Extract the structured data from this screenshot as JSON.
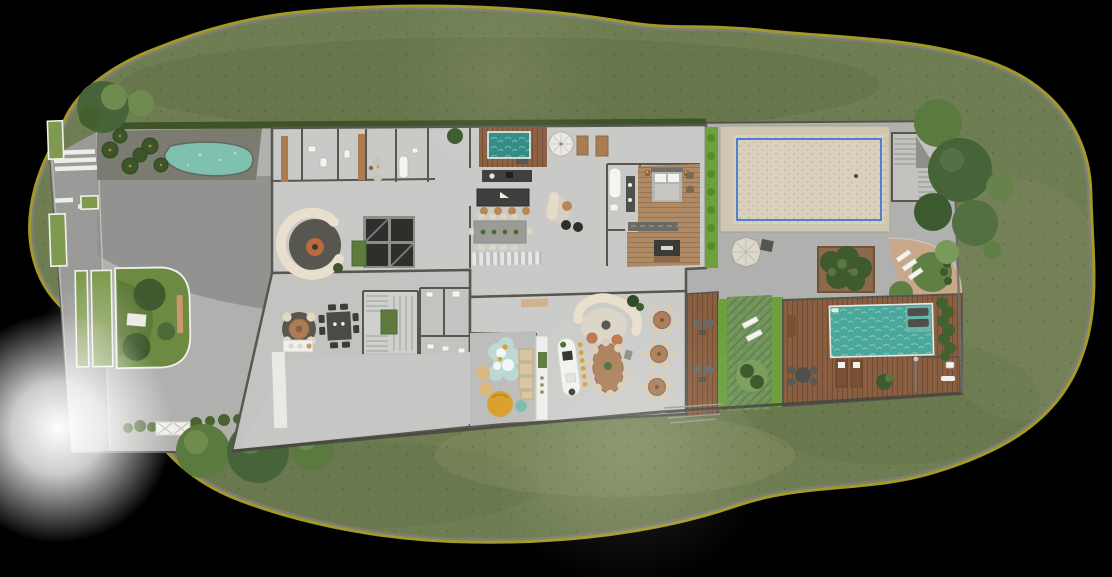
{
  "scene": {
    "type": "architectural-site-plan",
    "view": "top-down ground-floor rendering",
    "canvas": {
      "width": 1112,
      "height": 577
    }
  },
  "palette": {
    "background": "#000000",
    "grass": "#6f7d52",
    "grass_dark": "#5c6a43",
    "grass_light": "#8a9767",
    "rim_olive": "#a29a28",
    "rim_road": "#7e7e76",
    "plot": "#b0b0ae",
    "street": "#9a9a98",
    "asphalt_dark": "#929290",
    "apron": "#bdbdbb",
    "floor": "#c9c9c7",
    "floor_alt": "#c3c3c1",
    "floor_party": "#cbcbc9",
    "wall": "#57574f",
    "wood": "#8a5f41",
    "wood_light": "#a97c52",
    "wood_floor": "#b08a64",
    "pool": "#4aa79b",
    "plunge": "#2f8b85",
    "pond": "#7fc0ae",
    "sand": "#d9d1be",
    "sand_border": "#cfc7b2",
    "court_line": "#3a6fd8",
    "hedge": "#6da13e",
    "hedge_dark": "#42612f",
    "lawn_panel": "#70945a",
    "lawn_circle": "#5e8045",
    "tree_dark": "#47633a",
    "tree_mid": "#5a7a40",
    "tree_light": "#6f8c4e",
    "cream": "#e8dfcc",
    "orange": "#bf7549",
    "yellow": "#d9a02b",
    "path_pink": "#c9a78b",
    "white": "#f2f2ef",
    "counter_dark": "#3f3f3d",
    "rug_dark": "#57574f",
    "table_wood": "#aa7d57"
  },
  "elements": [
    "perimeter-road-rim",
    "meadow",
    "access-street",
    "crosswalk",
    "median-strips",
    "palm-garden",
    "ornamental-pond",
    "driveway",
    "driveway-apron",
    "lawn-island",
    "picnic-blanket",
    "garden-bench",
    "main-building",
    "dressing-rooms",
    "bathrooms",
    "internal-courtyard-skylight",
    "fire-lounge",
    "kitchen-island",
    "dining-table",
    "spa-plunge-pool",
    "patio-umbrella",
    "master-suite",
    "bed",
    "bathtub",
    "wardrobe",
    "tv-unit",
    "games-table",
    "round-table",
    "stairs",
    "planter-stairs",
    "service-toilets",
    "garage-ramp",
    "kids-playroom",
    "play-mat",
    "poufs",
    "bar-counter",
    "party-lounge-sofa",
    "banquet-oval-table",
    "round-dining-tables",
    "timber-deck",
    "relax-lawn-panel",
    "sun-loungers",
    "swimming-pool",
    "pool-shelf-loungers",
    "outdoor-shower",
    "sand-sports-court",
    "court-blue-line",
    "outdoor-staircase",
    "pergola-umbrella",
    "tree-planter",
    "curved-garden-path",
    "lawn-circles",
    "hedgerow",
    "trellis-gate",
    "trees",
    "light-glow"
  ]
}
